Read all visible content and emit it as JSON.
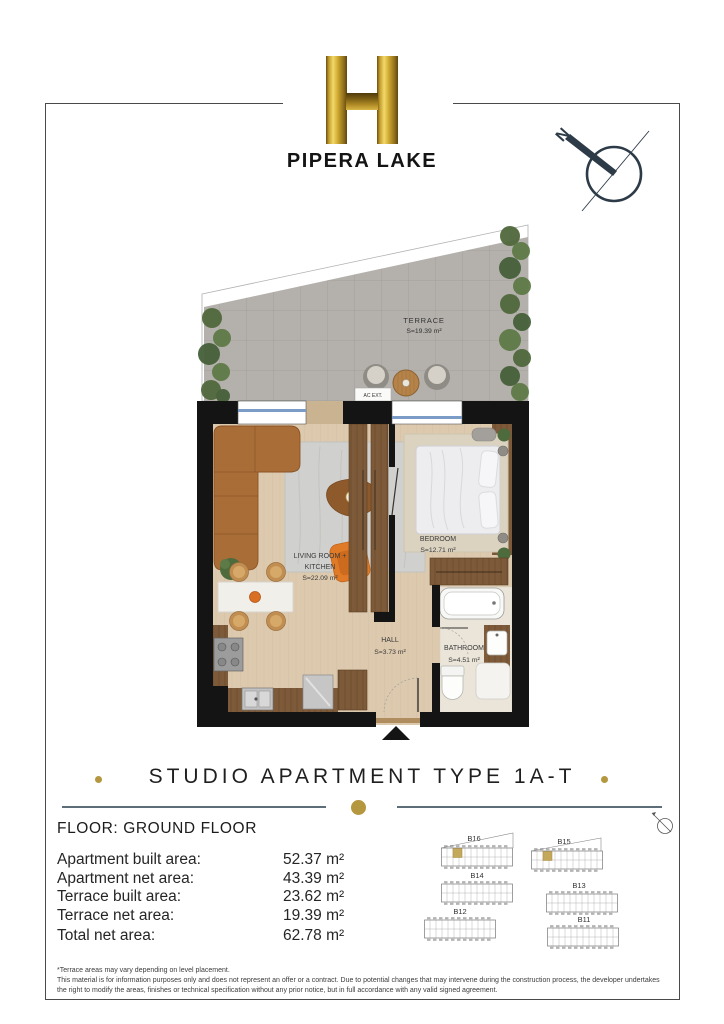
{
  "brand": {
    "logo_letter": "H",
    "name": "PIPERA LAKE"
  },
  "compass": {
    "north_label": "N"
  },
  "colors": {
    "gold_accent": "#b5973f",
    "logo_gold": "#d2ac33",
    "compass_navy": "#2d3b48",
    "wall_black": "#141414",
    "terrace_gray": "#b4b1ac",
    "floor_tan": "#ddc9ae",
    "wood_brown": "#7d5a39",
    "window_blue": "#7b9cc7",
    "highlight_unit_gold": "#c4a85c"
  },
  "icons": {
    "compass": "compass-rose-icon",
    "mini_compass": "small-compass-icon",
    "entrance": "entrance-triangle-arrow"
  },
  "floor_plan": {
    "terrace_name": "TERRACE",
    "terrace_area": "S=19.39 m²",
    "ac_label": "AC EXT.",
    "living_name_1": "LIVING ROOM +",
    "living_name_2": "KITCHEN",
    "living_area": "S=22.09 m²",
    "bedroom_name": "BEDROOM",
    "bedroom_area": "S=12.71 m²",
    "hall_name": "HALL",
    "hall_area": "S=3.73 m²",
    "bathroom_name": "BATHROOM",
    "bathroom_area": "S=4.51 m²"
  },
  "title": "STUDIO APARTMENT TYPE 1A-T",
  "floor_label": "FLOOR: GROUND FLOOR",
  "areas": [
    {
      "label": "Apartment built area:",
      "value": "52.37 m²"
    },
    {
      "label": "Apartment net area:",
      "value": "43.39 m²"
    },
    {
      "label": "Terrace built area:",
      "value": "23.62 m²"
    },
    {
      "label": "Terrace net area:",
      "value": "19.39 m²"
    },
    {
      "label": "Total net area:",
      "value": "62.78 m²"
    }
  ],
  "buildings": [
    {
      "id": "B16",
      "highlighted": true
    },
    {
      "id": "B15",
      "highlighted": true
    },
    {
      "id": "B14",
      "highlighted": false
    },
    {
      "id": "B13",
      "highlighted": false
    },
    {
      "id": "B12",
      "highlighted": false
    },
    {
      "id": "B11",
      "highlighted": false
    }
  ],
  "disclaimer": {
    "line1": "*Terrace areas may vary depending on level placement.",
    "line2": "This material is for information purposes only and does not represent an offer or a contract. Due to potential changes that may intervene during the construction process, the developer undertakes the right to modify the areas, finishes or technical specification without any prior notice, but in full accordance with any valid signed agreement."
  }
}
